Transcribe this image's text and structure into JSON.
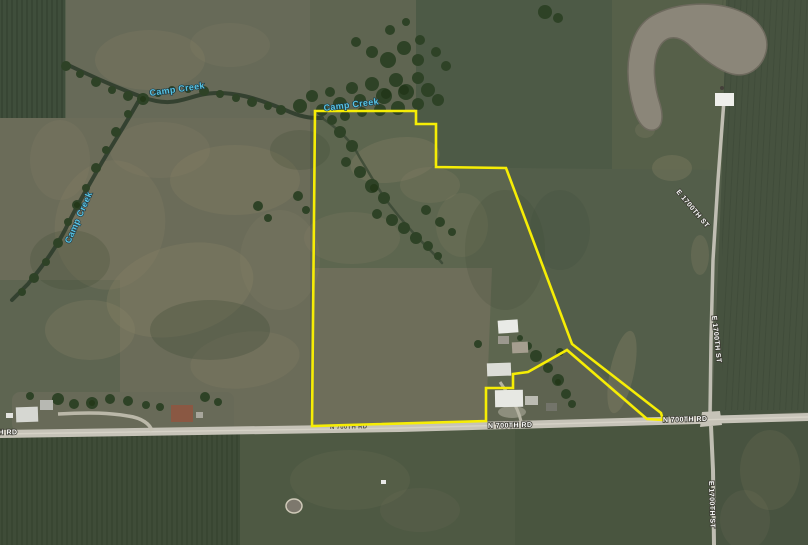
{
  "meta": {
    "view": "aerial-imagery-with-parcel-overlay",
    "width_px": 808,
    "height_px": 545
  },
  "labels": {
    "creek": "Camp Creek",
    "road_horizontal": "N 700TH RD",
    "road_vertical": "E 1700TH ST"
  },
  "colors": {
    "parcel_boundary": "#f6ed05",
    "creek_label": "#58c9ec",
    "road_label": "#ffffff",
    "road_surface": "#c6c3b8",
    "water": "#8b8679"
  },
  "parcel": {
    "boundary_points": "315,111 416,111 416,124 436,124 436,167 506,168 572,344 661,413 663,420 647,419 567,350 528,372 513,374 513,388 486,388 486,421 312,426"
  }
}
